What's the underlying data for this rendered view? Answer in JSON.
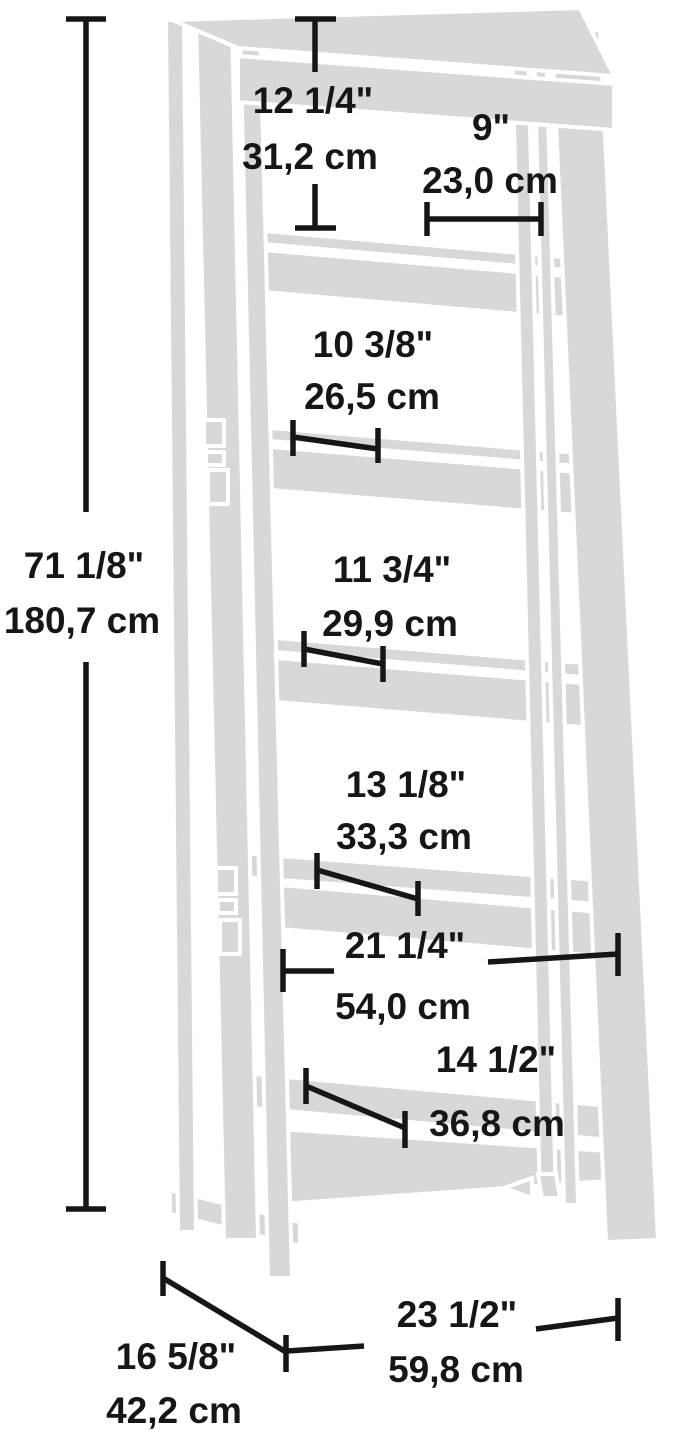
{
  "diagram": {
    "subject": "ladder bookshelf dimension drawing",
    "colors": {
      "furniture_fill": "#d8d8d8",
      "outline": "#ffffff",
      "dimension_ink": "#161616",
      "background": "#ffffff"
    },
    "dimensions": {
      "overall_height": {
        "inches": "71 1/8\"",
        "cm": "180,7 cm"
      },
      "top_opening_height": {
        "inches": "12 1/4\"",
        "cm": "31,2 cm"
      },
      "top_shelf_depth": {
        "inches": "9\"",
        "cm": "23,0 cm"
      },
      "second_shelf_depth": {
        "inches": "10 3/8\"",
        "cm": "26,5 cm"
      },
      "third_shelf_depth": {
        "inches": "11 3/4\"",
        "cm": "29,9 cm"
      },
      "fourth_shelf_depth": {
        "inches": "13 1/8\"",
        "cm": "33,3 cm"
      },
      "interior_width": {
        "inches": "21 1/4\"",
        "cm": "54,0 cm"
      },
      "bottom_shelf_depth": {
        "inches": "14 1/2\"",
        "cm": "36,8 cm"
      },
      "overall_depth": {
        "inches": "16 5/8\"",
        "cm": "42,2 cm"
      },
      "overall_width": {
        "inches": "23 1/2\"",
        "cm": "59,8 cm"
      }
    }
  }
}
